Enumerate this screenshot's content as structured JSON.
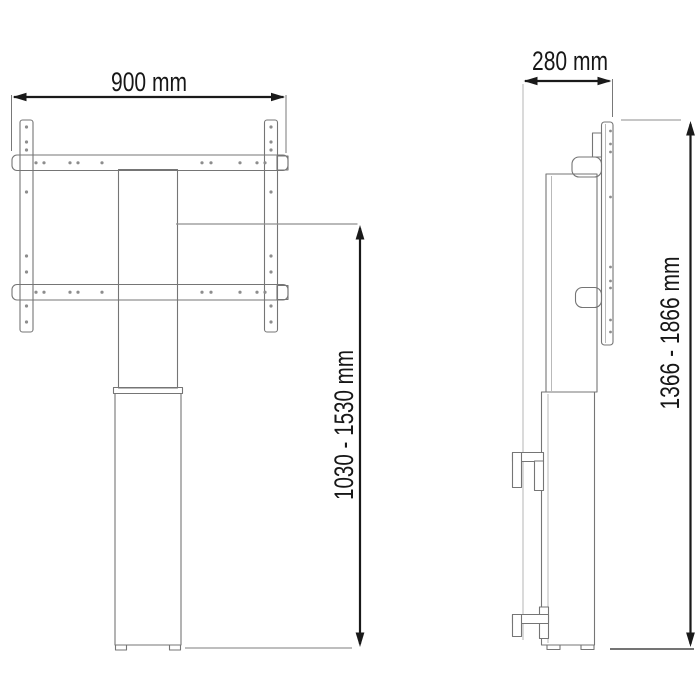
{
  "diagram": {
    "front_view": {
      "width_label": "900 mm",
      "height_label": "1030 - 1530 mm"
    },
    "side_view": {
      "depth_label": "280 mm",
      "height_label": "1366 - 1866 mm"
    },
    "colors": {
      "dimension_line": "#1a1a1a",
      "drawing_line": "#757575",
      "reference_line": "#9a9a9a",
      "background": "#ffffff"
    }
  }
}
